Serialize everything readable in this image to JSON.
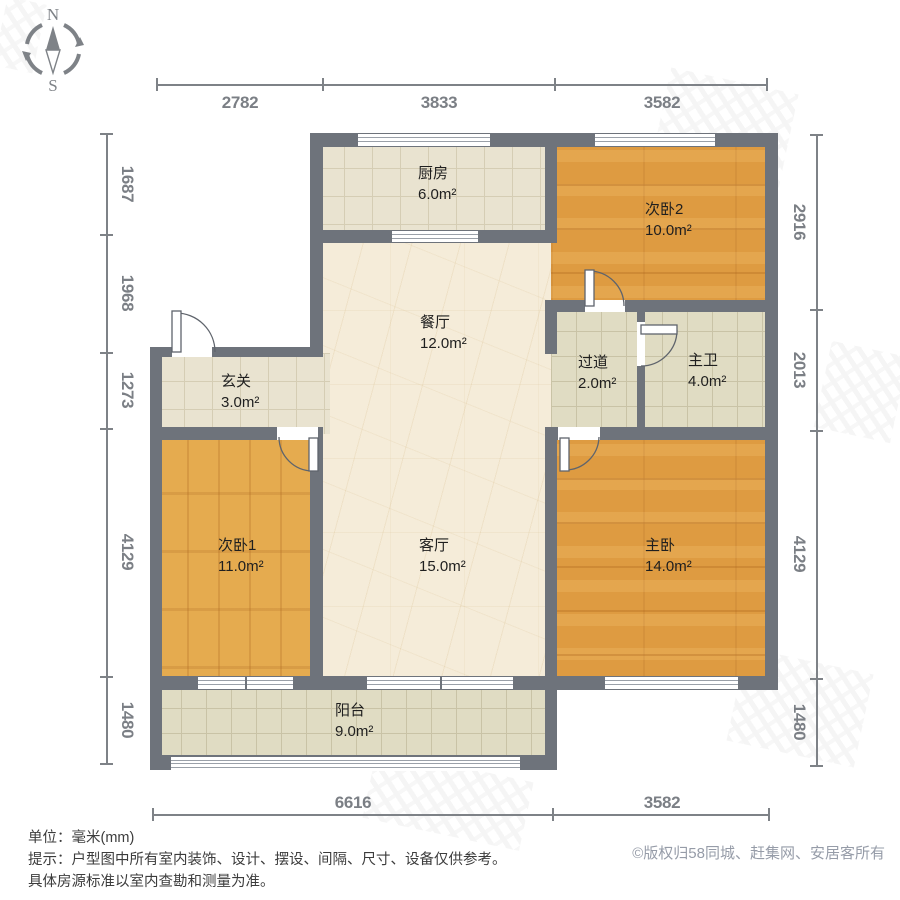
{
  "compass": {
    "north": "N",
    "south": "S"
  },
  "rooms": [
    {
      "id": "kitchen",
      "name": "厨房",
      "area": "6.0m²"
    },
    {
      "id": "bedroom2",
      "name": "次卧2",
      "area": "10.0m²"
    },
    {
      "id": "dining",
      "name": "餐厅",
      "area": "12.0m²"
    },
    {
      "id": "hallway",
      "name": "过道",
      "area": "2.0m²"
    },
    {
      "id": "bathroom",
      "name": "主卫",
      "area": "4.0m²"
    },
    {
      "id": "entry",
      "name": "玄关",
      "area": "3.0m²"
    },
    {
      "id": "bedroom1",
      "name": "次卧1",
      "area": "11.0m²"
    },
    {
      "id": "living",
      "name": "客厅",
      "area": "15.0m²"
    },
    {
      "id": "master",
      "name": "主卧",
      "area": "14.0m²"
    },
    {
      "id": "balcony",
      "name": "阳台",
      "area": "9.0m²"
    }
  ],
  "dimensions_mm": {
    "top": [
      "2782",
      "3833",
      "3582"
    ],
    "left": [
      "1687",
      "1968",
      "1273",
      "4129",
      "1480"
    ],
    "right": [
      "2916",
      "2013",
      "4129",
      "1480"
    ],
    "bottom": [
      "6616",
      "3582"
    ]
  },
  "footer": {
    "line1": "单位：毫米(mm)",
    "line2": "提示：户型图中所有室内装饰、设计、摆设、间隔、尺寸、设备仅供参考。",
    "line3": "具体房源标准以室内查勘和测量为准。",
    "copyright": "©版权归58同城、赶集网、安居客所有"
  },
  "colors": {
    "wall": "#6e737b",
    "wood": "#de9b41",
    "wood_light": "#e5ab4f",
    "tile_warm": "#e9e3d0",
    "tile_cool": "#e0dcc3",
    "marble": "#f5ecd9",
    "dimension_text": "#7b7f85",
    "label_text": "#1f1f1f",
    "copyright_text": "#969ca8"
  }
}
